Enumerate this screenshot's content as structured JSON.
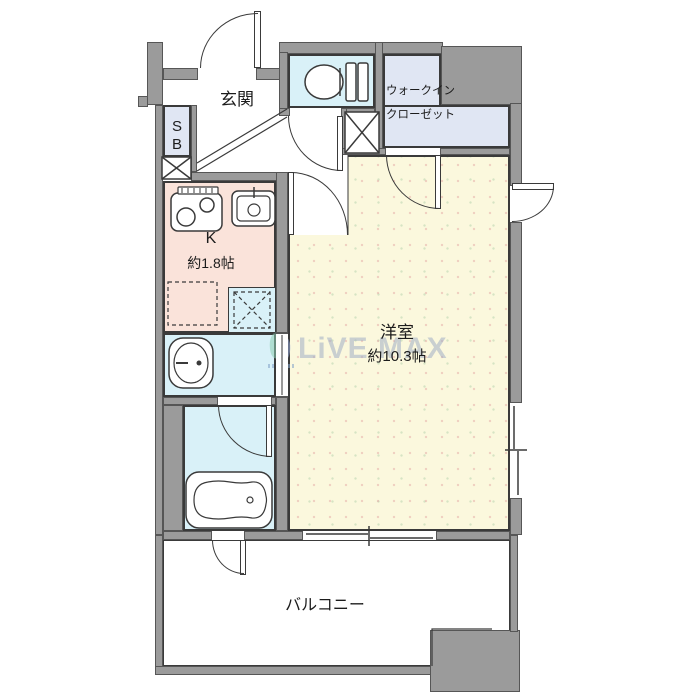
{
  "plan_type": "apartment-floorplan",
  "rooms": {
    "entrance": {
      "label": "玄関"
    },
    "shoe_box": {
      "line1": "S",
      "line2": "B"
    },
    "walk_in_closet": {
      "line1": "ウォークイン",
      "line2": "クローゼット"
    },
    "kitchen": {
      "label": "K",
      "size": "約1.8帖"
    },
    "western_room": {
      "label": "洋室",
      "size": "約10.3帖"
    },
    "balcony": {
      "label": "バルコニー"
    }
  },
  "watermark": {
    "brand": "LiVE MAX"
  },
  "colors": {
    "wall": "#9b9b9b",
    "wet_area": "#d9f1f8",
    "closet": "#e0e6f3",
    "kitchen": "#fae3da",
    "main_room": "#fbf8dd",
    "balcony": "#ffffff",
    "line": "#3a3a3a",
    "watermark_text": "#a2aec6"
  }
}
